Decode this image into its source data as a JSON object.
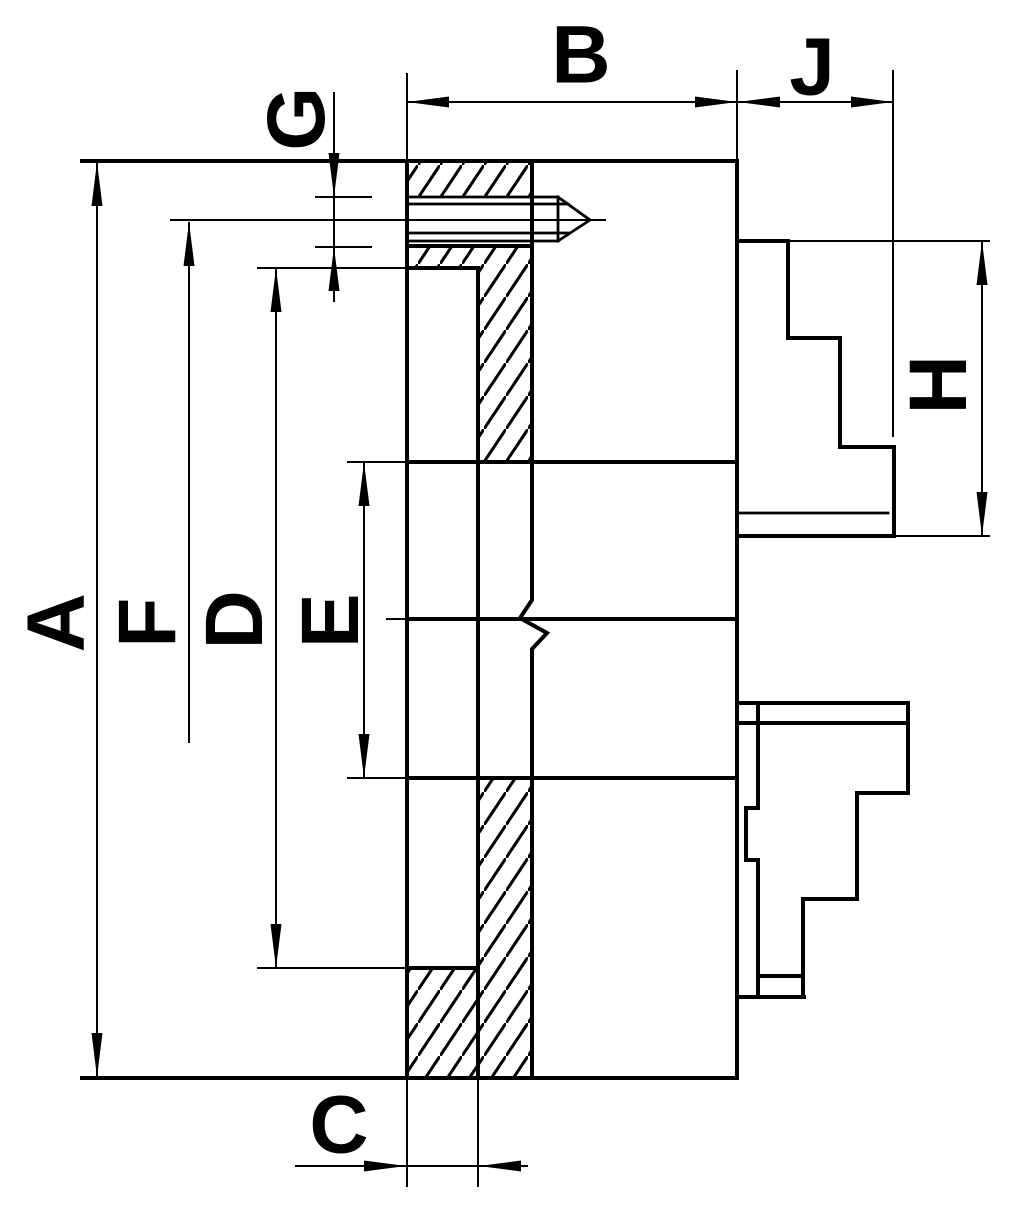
{
  "drawing": {
    "background": "#ffffff",
    "line_color": "#000000",
    "dimension_labels": {
      "a": "A",
      "b": "B",
      "c": "C",
      "d": "D",
      "e": "E",
      "f": "F",
      "g": "G",
      "h": "H",
      "j": "J"
    }
  }
}
